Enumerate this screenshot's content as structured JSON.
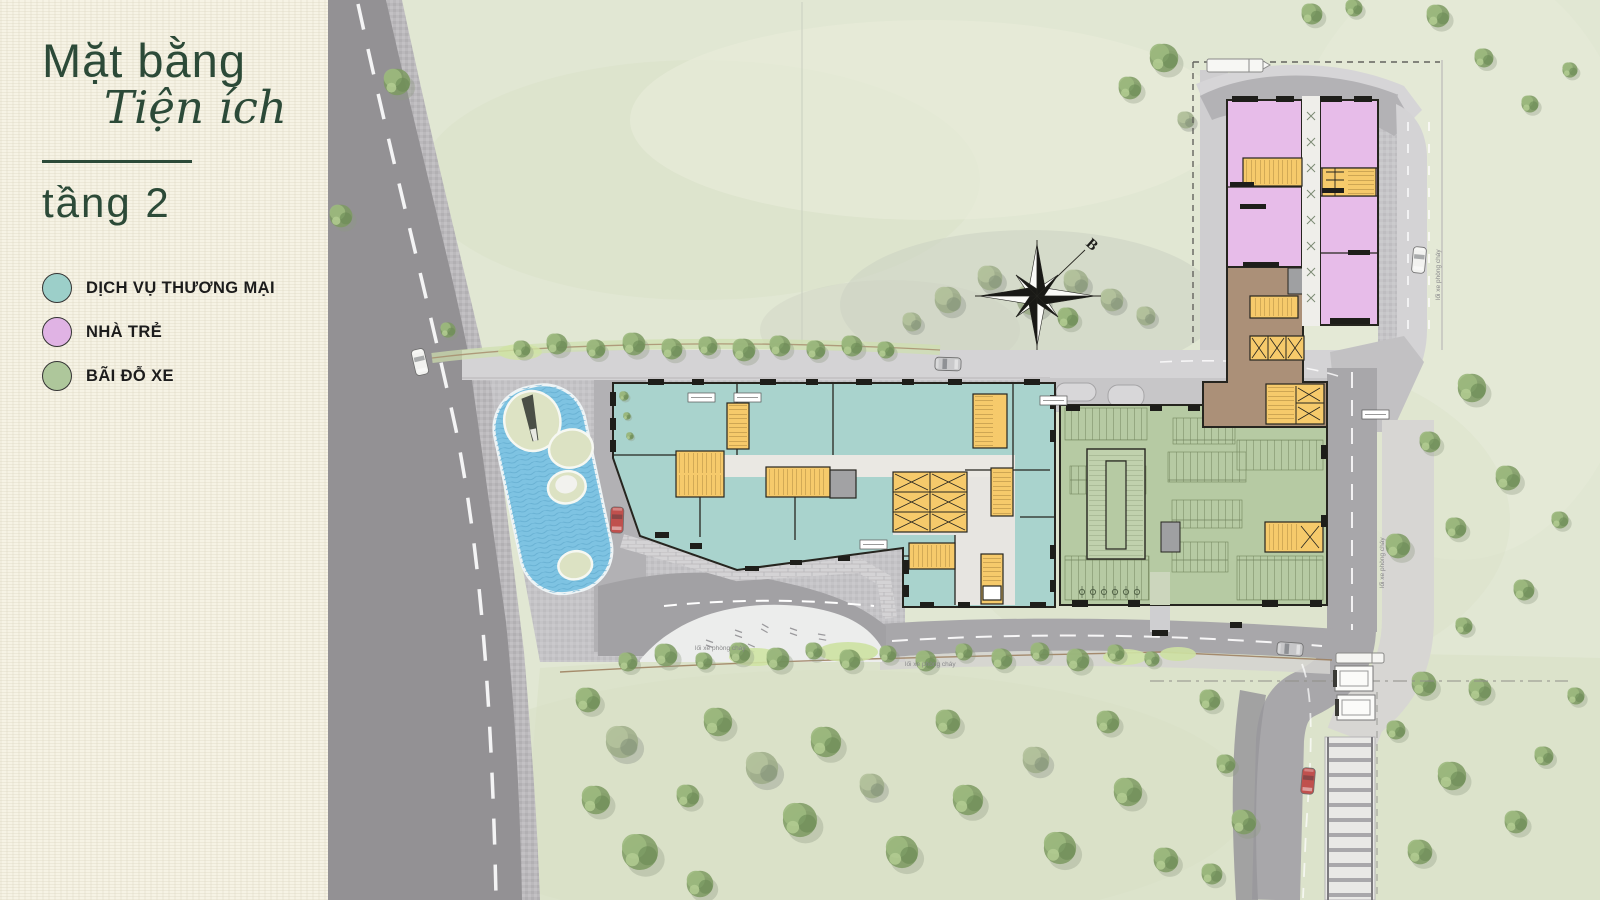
{
  "panel": {
    "title_line1": "Mặt bằng",
    "title_line2": "Tiện ích",
    "floor_label": "tầng 2"
  },
  "legend": {
    "items": [
      {
        "key": "commercial-services",
        "label": "DỊCH VỤ THƯƠNG MẠI",
        "color": "#9ccfc9"
      },
      {
        "key": "kindergarten",
        "label": "NHÀ TRẺ",
        "color": "#e0b3e4"
      },
      {
        "key": "parking",
        "label": "BÃI ĐỖ XE",
        "color": "#aec79b"
      }
    ]
  },
  "plan": {
    "compass_label": "B",
    "fire_lane_label": "lối xe phòng cháy",
    "zone_colors": {
      "commercial": "#a9d3cd",
      "kindergarten": "#e7bce9",
      "parking_garage": "#b6caa3",
      "connector_building": "#ab9078",
      "stair_core": "#f6ca6b",
      "water": "#7ec3e2",
      "grass": "#e1e7d3",
      "asphalt": "#939194",
      "title_green": "#2c4a38"
    }
  }
}
